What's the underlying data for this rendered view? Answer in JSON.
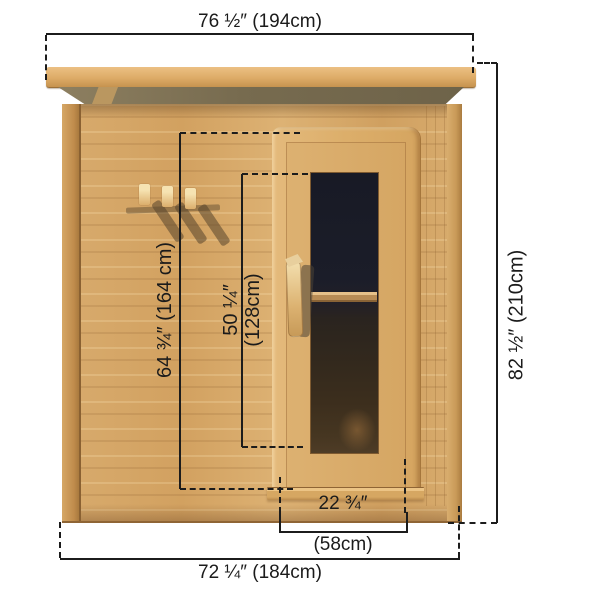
{
  "diagram": {
    "subject": "sauna-front-elevation",
    "dimensions": {
      "top_width": "76 ½″ (194cm)",
      "right_height": "82 ½″ (210cm)",
      "bottom_width": "72 ¼″ (184cm)",
      "wall_height": "64 ¾″ (164 cm)",
      "glass_height_in": "50 ¼″",
      "glass_height_cm": "(128cm)",
      "door_width_in": "22 ¾″",
      "door_width_cm": "(58cm)"
    },
    "colors": {
      "background": "#ffffff",
      "wood_light": "#e6bc7e",
      "wood_mid": "#d5a765",
      "wood_dark": "#b9874b",
      "trim_edge": "#8a6132",
      "fascia": "#776b4f",
      "glass_dark": "#1a1c27",
      "glass_brown": "#3e2f1e",
      "dimension_line": "#1c1c1c"
    }
  }
}
